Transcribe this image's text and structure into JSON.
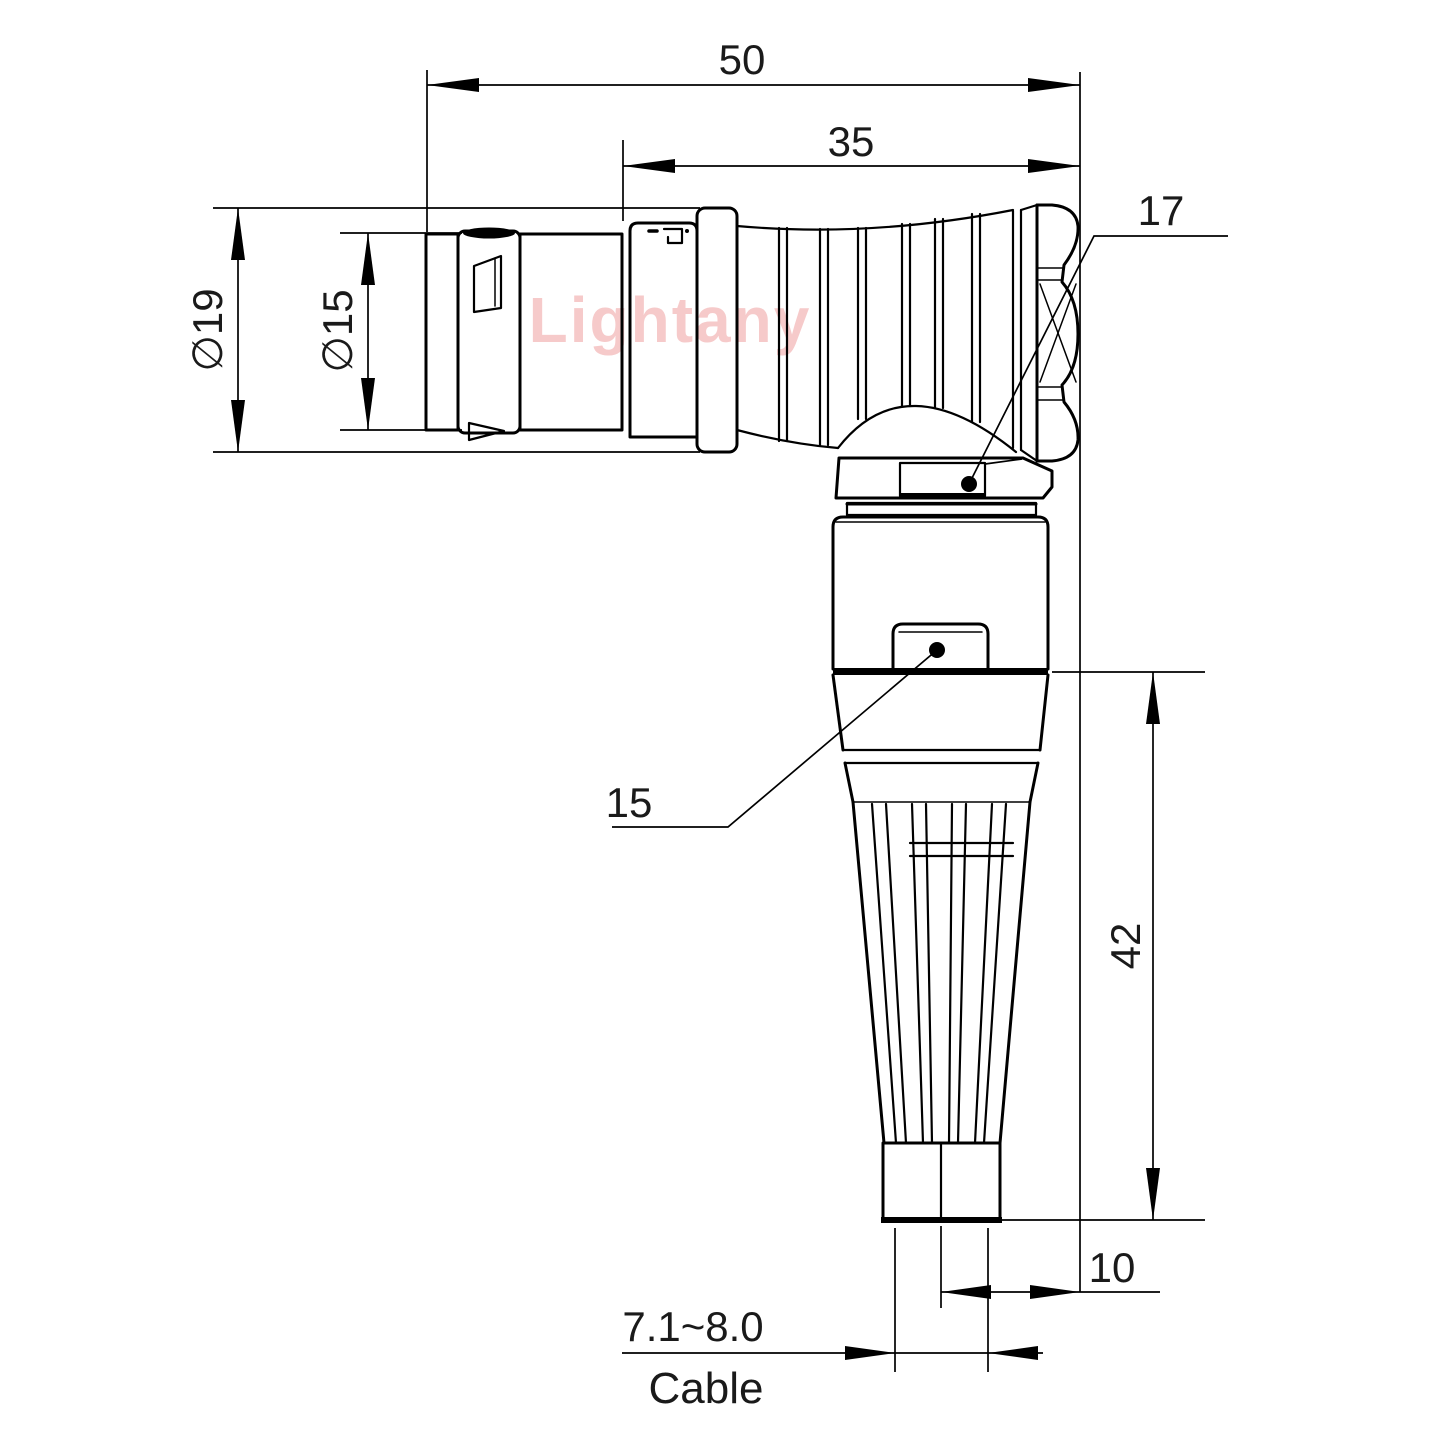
{
  "drawing": {
    "watermark": "Lightany",
    "dims": {
      "overall_length": "50",
      "rear_length": "35",
      "outer_diameter": "∅19",
      "nose_diameter": "∅15",
      "hex_flats": "17",
      "body_flats": "15",
      "height": "42",
      "axis_offset": "10",
      "cable_diameter_range": "7.1~8.0",
      "cable_label": "Cable"
    },
    "colors": {
      "line": "#000000",
      "text": "#1a1a1a",
      "watermark": "#f6caca",
      "background": "#ffffff"
    }
  }
}
